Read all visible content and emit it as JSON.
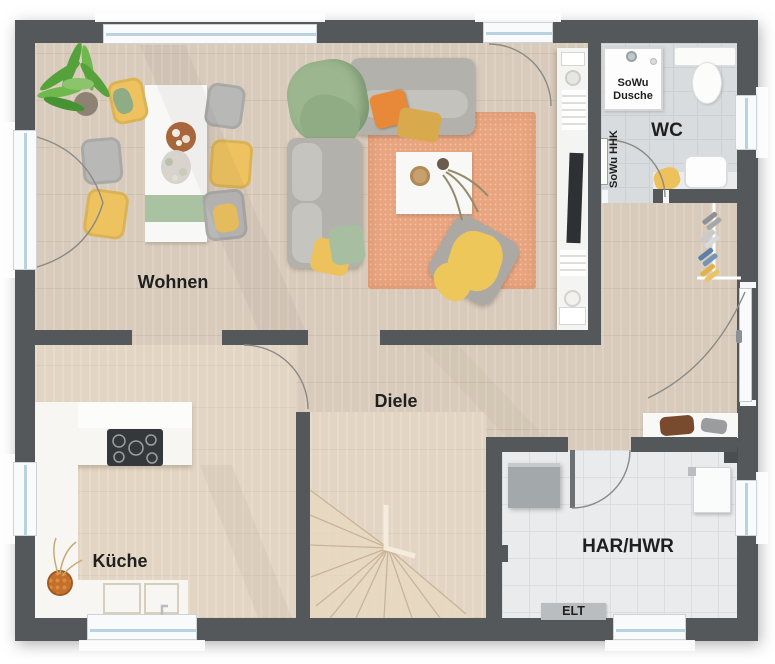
{
  "floorplan": {
    "room_labels": {
      "wohnen": "Wohnen",
      "diele": "Diele",
      "kueche": "Küche",
      "wc": "WC",
      "har_hwr": "HAR/HWR"
    },
    "annotations": {
      "sowu_dusche_line1": "SoWu",
      "sowu_dusche_line2": "Dusche",
      "sowu_hhk": "SoWu HHK",
      "elt": "ELT"
    },
    "palette": {
      "wall": "#55585b",
      "wood_floor": "#d8cbbb",
      "kitchen_floor": "#e3d5c3",
      "wc_tile": "#d9dcde",
      "har_tile": "#e9ebed",
      "window_glass": "#b9d2e0",
      "rug": "#e9a57f",
      "sofa_gray": "#b3b1ac",
      "accent_yellow": "#eec35f",
      "accent_orange": "#e8893a",
      "accent_green": "#9cb78f",
      "label_text": "#1f1f1f"
    }
  }
}
